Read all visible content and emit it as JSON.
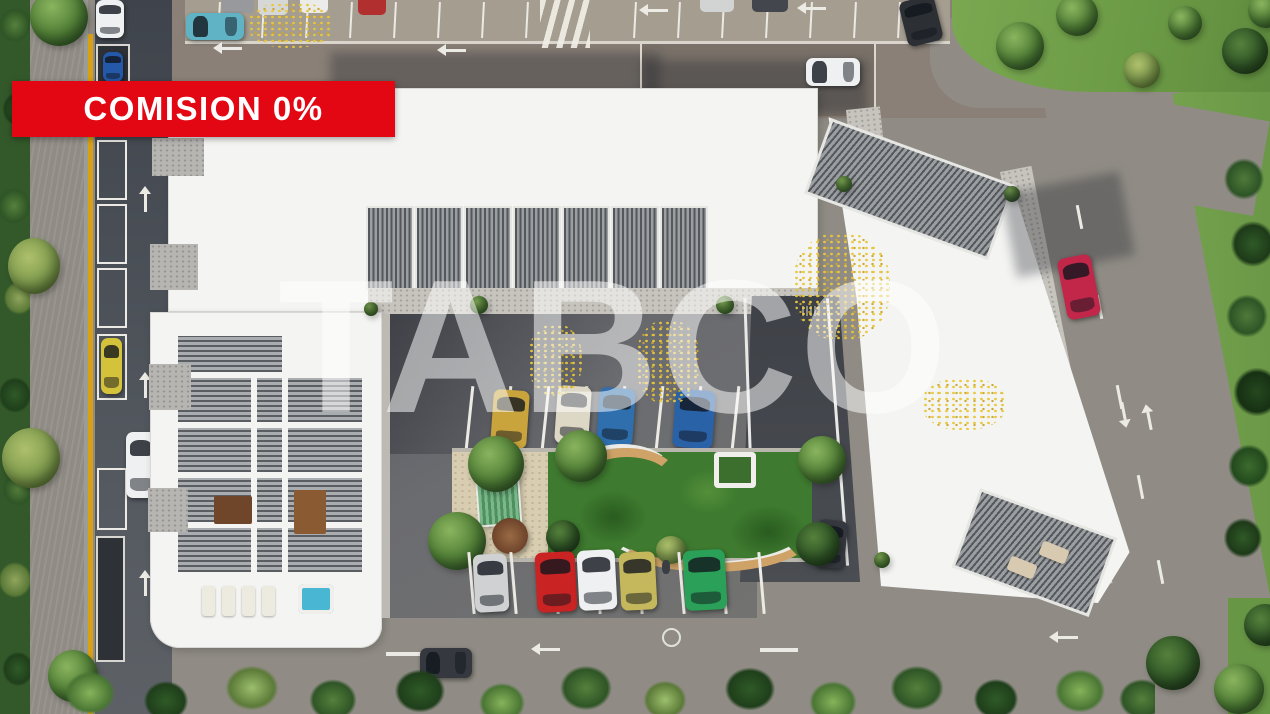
{
  "banner": {
    "label": "COMISION 0%"
  },
  "watermark": {
    "text": "TABCO"
  },
  "palette": {
    "banner-red": "#e30613",
    "banner-text": "#ffffff",
    "water": "#5fa3a6",
    "grass": "#71a04b",
    "road-top": "#8a8077",
    "road-light": "#908c85",
    "road-dark": "#4a4f56",
    "lot": "#696a6e",
    "roof-white": "#f4f4f2",
    "gravel": "#c7c4be",
    "slat-dark": "#5a5d61",
    "slat-light": "#aaadaf",
    "line": "#eceae4",
    "rail-yellow": "#d8a012",
    "sand": "#d8cdb0",
    "lawn": "#3e7a2f",
    "wood": "#cfa367",
    "jacuzzi": "#49b7d4",
    "car-gold": "#c9a33c",
    "car-beige": "#ddd8c6",
    "car-blue": "#2f6fae",
    "car-blue2": "#2a62a8",
    "car-teal": "#5fb3c4",
    "car-silver": "#cfd1d2",
    "car-red": "#c92323",
    "car-white": "#eef0f1",
    "car-olive": "#c5b85c",
    "car-green": "#2aa058",
    "car-dark": "#35383e",
    "car-crimson": "#c2274a",
    "car-yellow": "#d4c23a"
  },
  "scene": {
    "type": "aerial-3d-render-residential-complex",
    "road_markings": [
      "left-arrows",
      "up-arrows",
      "down-arrow",
      "dashed-center-lines",
      "crosswalk",
      "circle-marking"
    ],
    "cars": {
      "inner_top_row": [
        "gold",
        "beige",
        "blue",
        "blue"
      ],
      "inner_bottom_row": [
        "silver",
        "red",
        "white",
        "olive",
        "green"
      ],
      "left_road": [
        "yellow",
        "white"
      ],
      "top_road": [
        "teal",
        "white",
        "white",
        "dark"
      ],
      "right_road": [
        "crimson-red"
      ],
      "bottom_road": [
        "dark-gray"
      ],
      "garage_ramp": [
        "dark-gray"
      ]
    },
    "features": [
      "canal",
      "courtyard-lawn",
      "playground",
      "jacuzzi",
      "pergola-roofs",
      "curved-benches"
    ]
  }
}
